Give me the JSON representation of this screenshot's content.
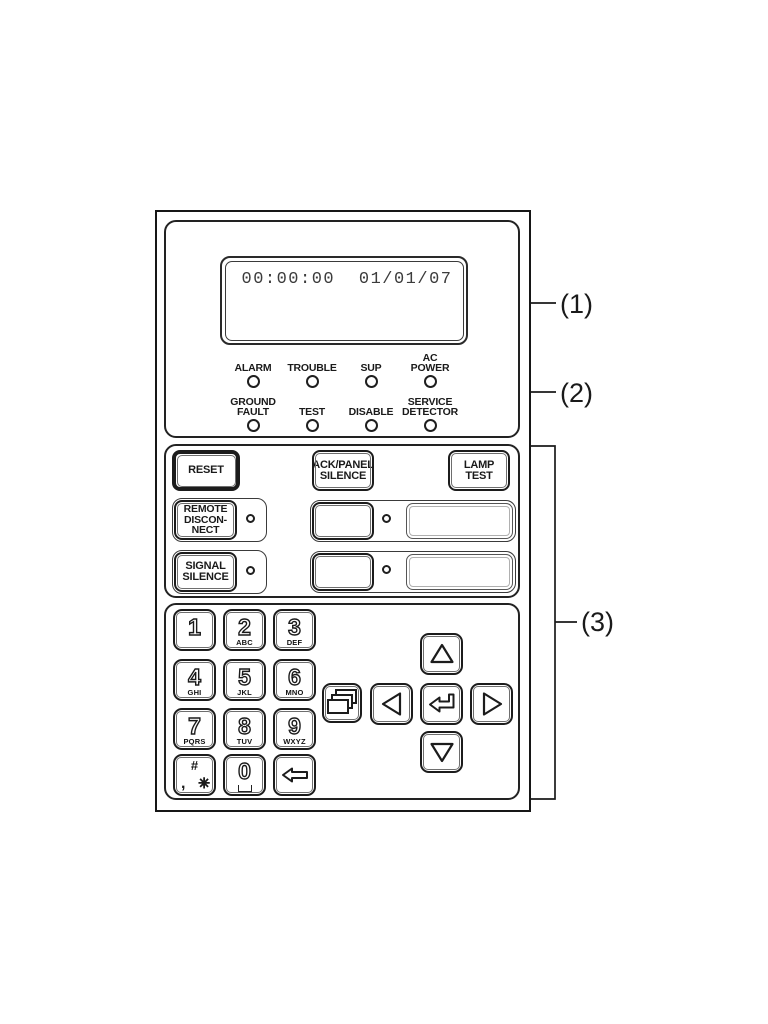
{
  "panel": {
    "display": {
      "time": "00:00:00",
      "date": "01/01/07"
    },
    "leds": [
      {
        "name": "alarm",
        "label": "ALARM"
      },
      {
        "name": "trouble",
        "label": "TROUBLE"
      },
      {
        "name": "sup",
        "label": "SUP"
      },
      {
        "name": "ac-power",
        "label": "AC\nPOWER"
      },
      {
        "name": "ground-fault",
        "label": "GROUND\nFAULT"
      },
      {
        "name": "test",
        "label": "TEST"
      },
      {
        "name": "disable",
        "label": "DISABLE"
      },
      {
        "name": "service-detector",
        "label": "SERVICE\nDETECTOR"
      }
    ],
    "buttons": {
      "reset": "RESET",
      "ack_panel_silence": "ACK/PANEL\nSILENCE",
      "lamp_test": "LAMP\nTEST",
      "remote_disconnect": "REMOTE\nDISCON-\nNECT",
      "signal_silence": "SIGNAL\nSILENCE"
    },
    "keypad": {
      "keys": [
        {
          "digit": "1",
          "letters": ""
        },
        {
          "digit": "2",
          "letters": "ABC"
        },
        {
          "digit": "3",
          "letters": "DEF"
        },
        {
          "digit": "4",
          "letters": "GHI"
        },
        {
          "digit": "5",
          "letters": "JKL"
        },
        {
          "digit": "6",
          "letters": "MNO"
        },
        {
          "digit": "7",
          "letters": "PQRS"
        },
        {
          "digit": "8",
          "letters": "TUV"
        },
        {
          "digit": "9",
          "letters": "WXYZ"
        }
      ],
      "hash_key": {
        "hash": "#",
        "comma": ",",
        "star": "✳"
      },
      "zero_key": {
        "digit": "0"
      },
      "icons": {
        "menu": "stacked-pages-icon",
        "backspace": "backspace-arrow-icon",
        "enter": "enter-arrow-icon",
        "up": "triangle-up-icon",
        "down": "triangle-down-icon",
        "left": "triangle-left-icon",
        "right": "triangle-right-icon"
      }
    }
  },
  "callouts": {
    "display": "(1)",
    "leds": "(2)",
    "keys": "(3)"
  },
  "colors": {
    "line": "#1a1a1a",
    "lcd_text": "#3c3c3c"
  }
}
